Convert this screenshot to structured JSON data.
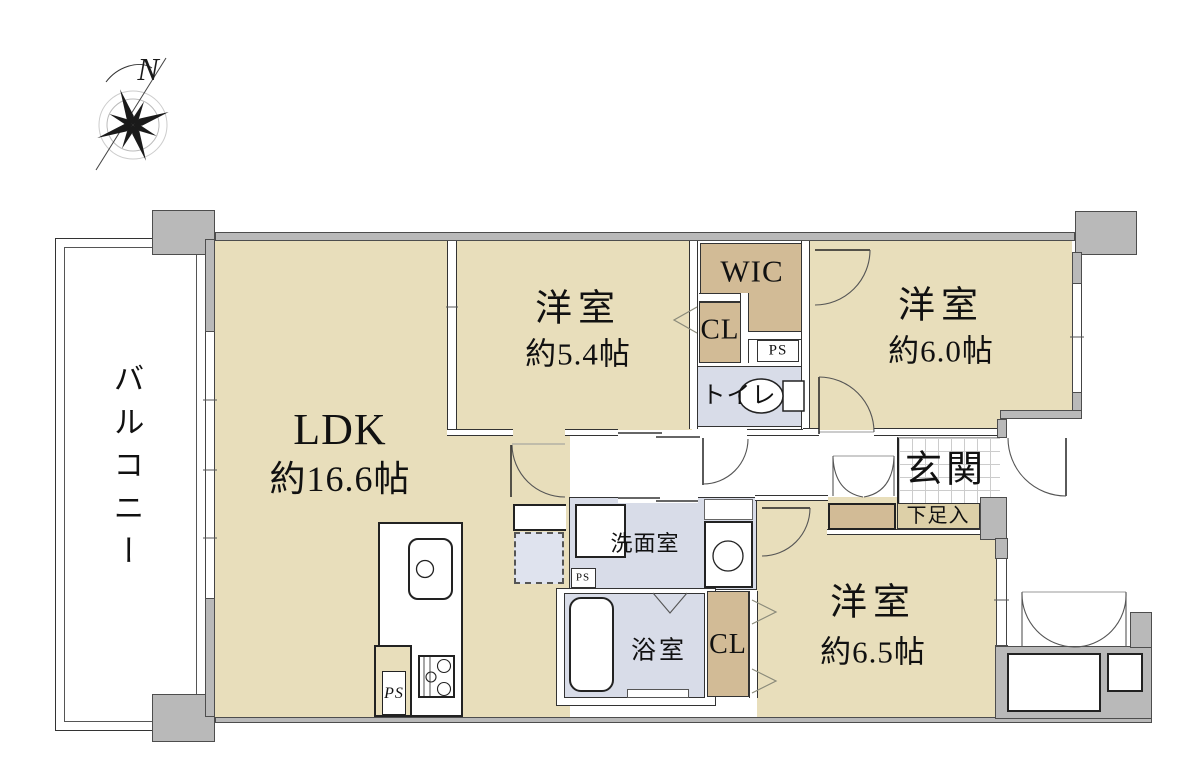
{
  "compass": {
    "label": "N"
  },
  "balcony": {
    "label": "バルコニー"
  },
  "rooms": {
    "ldk": {
      "name": "LDK",
      "size": "約16.6帖"
    },
    "bedroom1": {
      "name": "洋室",
      "size": "約5.4帖"
    },
    "bedroom2": {
      "name": "洋室",
      "size": "約6.0帖"
    },
    "bedroom3": {
      "name": "洋室",
      "size": "約6.5帖"
    },
    "wic": {
      "label": "WIC"
    },
    "closet_bedroom1": {
      "label": "CL"
    },
    "closet_bedroom3": {
      "label": "CL"
    },
    "toilet": {
      "label": "トイレ"
    },
    "washroom": {
      "label": "洗面室"
    },
    "bathroom": {
      "label": "浴室"
    },
    "entrance": {
      "label": "玄関"
    },
    "shoe_storage": {
      "label": "下足入"
    },
    "pipe_space_wic": {
      "label": "PS"
    },
    "pipe_space_washroom": {
      "label": "PS"
    },
    "pipe_space_kitchen": {
      "label": "PS"
    }
  },
  "colors": {
    "room_beige": "#e8debb",
    "closet_tan": "#d2bb96",
    "shoe_box_tan": "#ddd0a8",
    "wet_area_blue": "#d8dce8",
    "wall_gray": "#b9b9b9"
  }
}
